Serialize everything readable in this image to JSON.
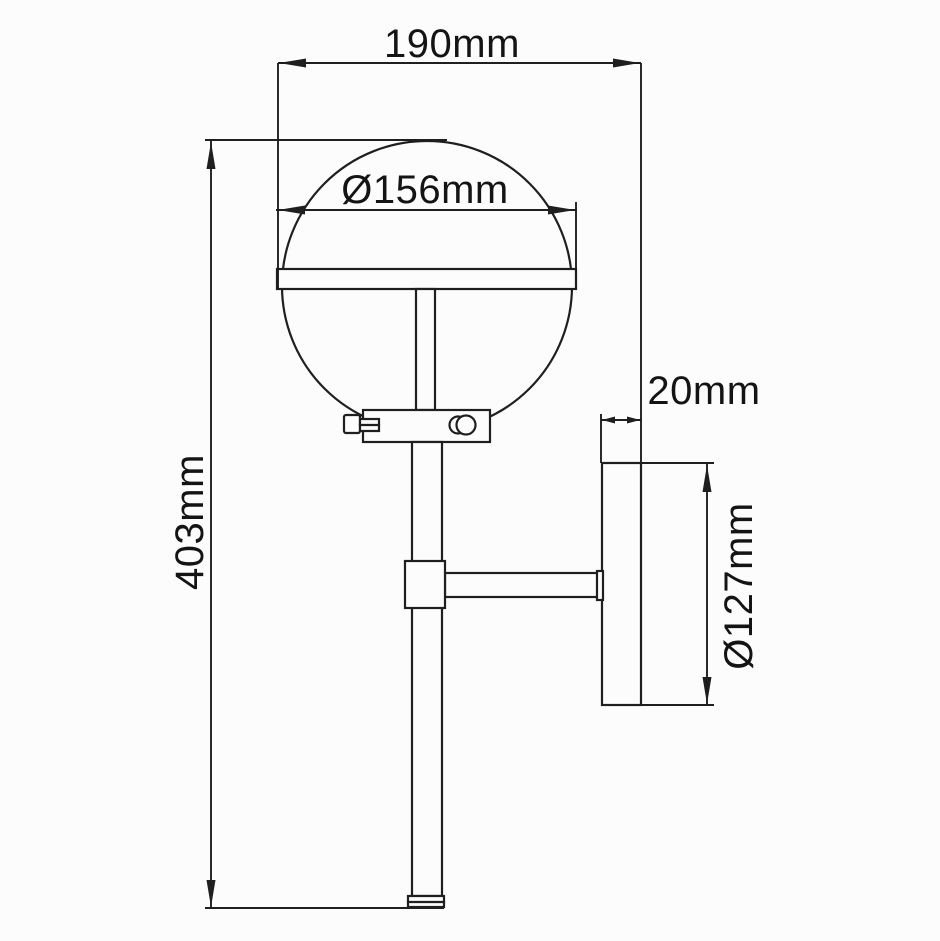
{
  "drawing": {
    "type": "technical dimension drawing",
    "view": "side elevation of globe wall light",
    "units": "mm"
  },
  "dimensions": {
    "projection_width": {
      "label": "190mm"
    },
    "shade_diameter": {
      "label": "Ø156mm"
    },
    "overall_height": {
      "label": "403mm"
    },
    "backplate_depth": {
      "label": "20mm"
    },
    "backplate_diameter": {
      "label": "Ø127mm"
    }
  },
  "colors": {
    "line": "#1f1f1f",
    "text": "#141414",
    "background": "#fcfcfc"
  }
}
